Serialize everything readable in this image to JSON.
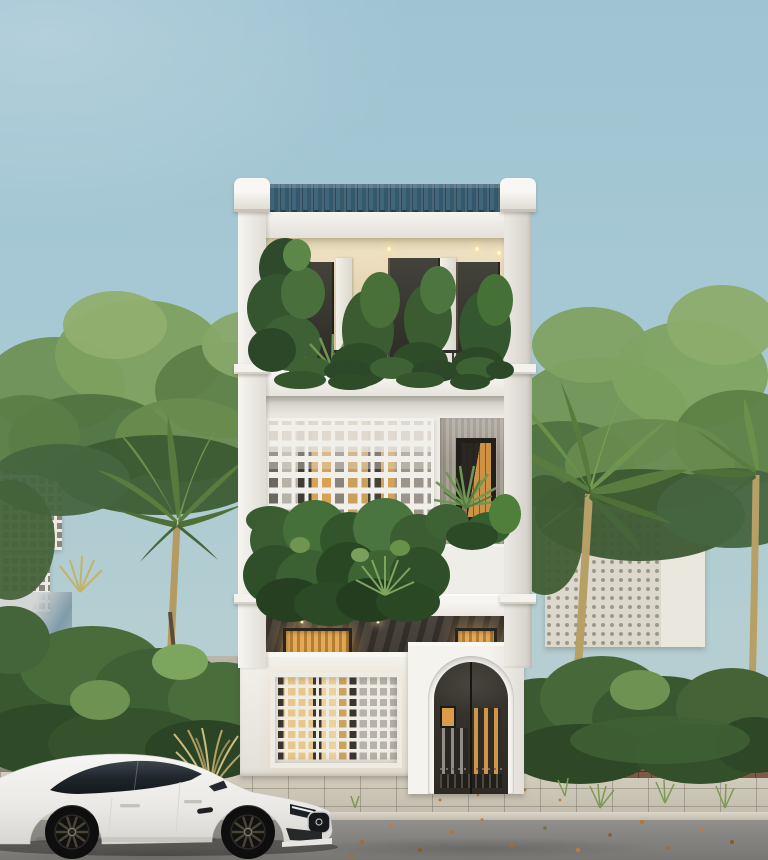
{
  "scene": {
    "description": "Front elevation render of a modern three-storey white townhouse with planted balconies, breeze-block screens, arched entry gate, boundary walls with tropical trees, and a white sports car parked on the street",
    "palette": {
      "sky_top": "#9fc3d2",
      "sky_bottom": "#bdd0cd",
      "roof_tiles": "#35596c",
      "wall_white": "#eeece6",
      "warm_ceiling": "#e9dcc0",
      "warm_wood": "#d39a4d",
      "stone_cladding": "#46403a",
      "gate_metal": "#38342e",
      "foliage_dark": "#2f4a28",
      "foliage_mid": "#4c6a38",
      "foliage_light": "#7da05d",
      "palm_trunk": "#b49b64",
      "weathered_wall": "#b5b1a7",
      "wall_shadow_blue": "#5d7688",
      "brick_planter": "#7d5946",
      "sidewalk": "#cbc5b6",
      "road_asphalt": "#83827f",
      "car_body": "#f0efec",
      "car_glass": "#20262b",
      "leaf_litter": "#c07a3a"
    },
    "objects": [
      "sky",
      "background tree canopy",
      "palm trees",
      "neighbor perforated screen walls",
      "three-storey townhouse",
      "blue tile roof",
      "top-floor planted balcony with downlights",
      "breeze-block facade screen",
      "hanging vine planter",
      "timber-look window bay",
      "dark stone ground-floor cladding with lit timber doors",
      "white perforated street fence",
      "arched metal entry gate with amber light",
      "weathered boundary walls",
      "brick planter strip",
      "white sports sedan",
      "tiled sidewalk and asphalt road with scattered leaves"
    ]
  }
}
